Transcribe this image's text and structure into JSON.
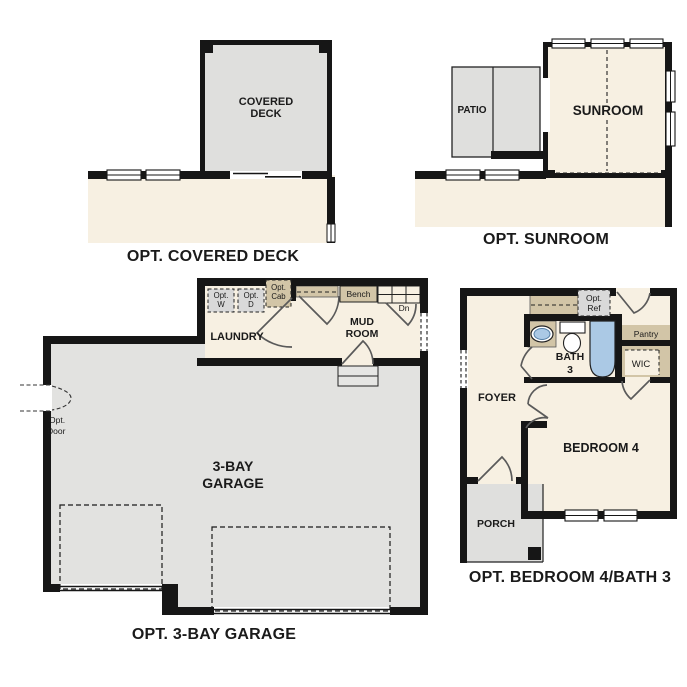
{
  "document": {
    "type": "floor-plan-options-sheet",
    "background": "#ffffff"
  },
  "colors": {
    "wall": "#161616",
    "interior_floor": "#f7f0e2",
    "concrete_gray": "#dfdfdd",
    "casework_tan": "#d2c5a7",
    "fixture_blue": "#abc9e5",
    "door_swing": "#5a5a5a"
  },
  "plans": {
    "covered_deck": {
      "title": "OPT. COVERED DECK",
      "deck_line1": "COVERED",
      "deck_line2": "DECK"
    },
    "sunroom": {
      "title": "OPT. SUNROOM",
      "room": "SUNROOM",
      "patio": "PATIO"
    },
    "garage": {
      "title": "OPT. 3-BAY GARAGE",
      "room_line1": "3-BAY",
      "room_line2": "GARAGE",
      "laundry": "LAUNDRY",
      "mud_line1": "MUD",
      "mud_line2": "ROOM",
      "bench": "Bench",
      "dn": "Dn",
      "opt_w_line1": "Opt.",
      "opt_w_line2": "W",
      "opt_d_line1": "Opt.",
      "opt_d_line2": "D",
      "opt_cab_line1": "Opt.",
      "opt_cab_line2": "Cab",
      "opt_door_line1": "Opt.",
      "opt_door_line2": "Door"
    },
    "bedroom4_bath3": {
      "title": "OPT. BEDROOM 4/BATH 3",
      "bedroom": "BEDROOM 4",
      "bath_line1": "BATH",
      "bath_line2": "3",
      "foyer": "FOYER",
      "porch": "PORCH",
      "wic": "WIC",
      "pantry": "Pantry",
      "opt_ref_line1": "Opt.",
      "opt_ref_line2": "Ref"
    }
  }
}
